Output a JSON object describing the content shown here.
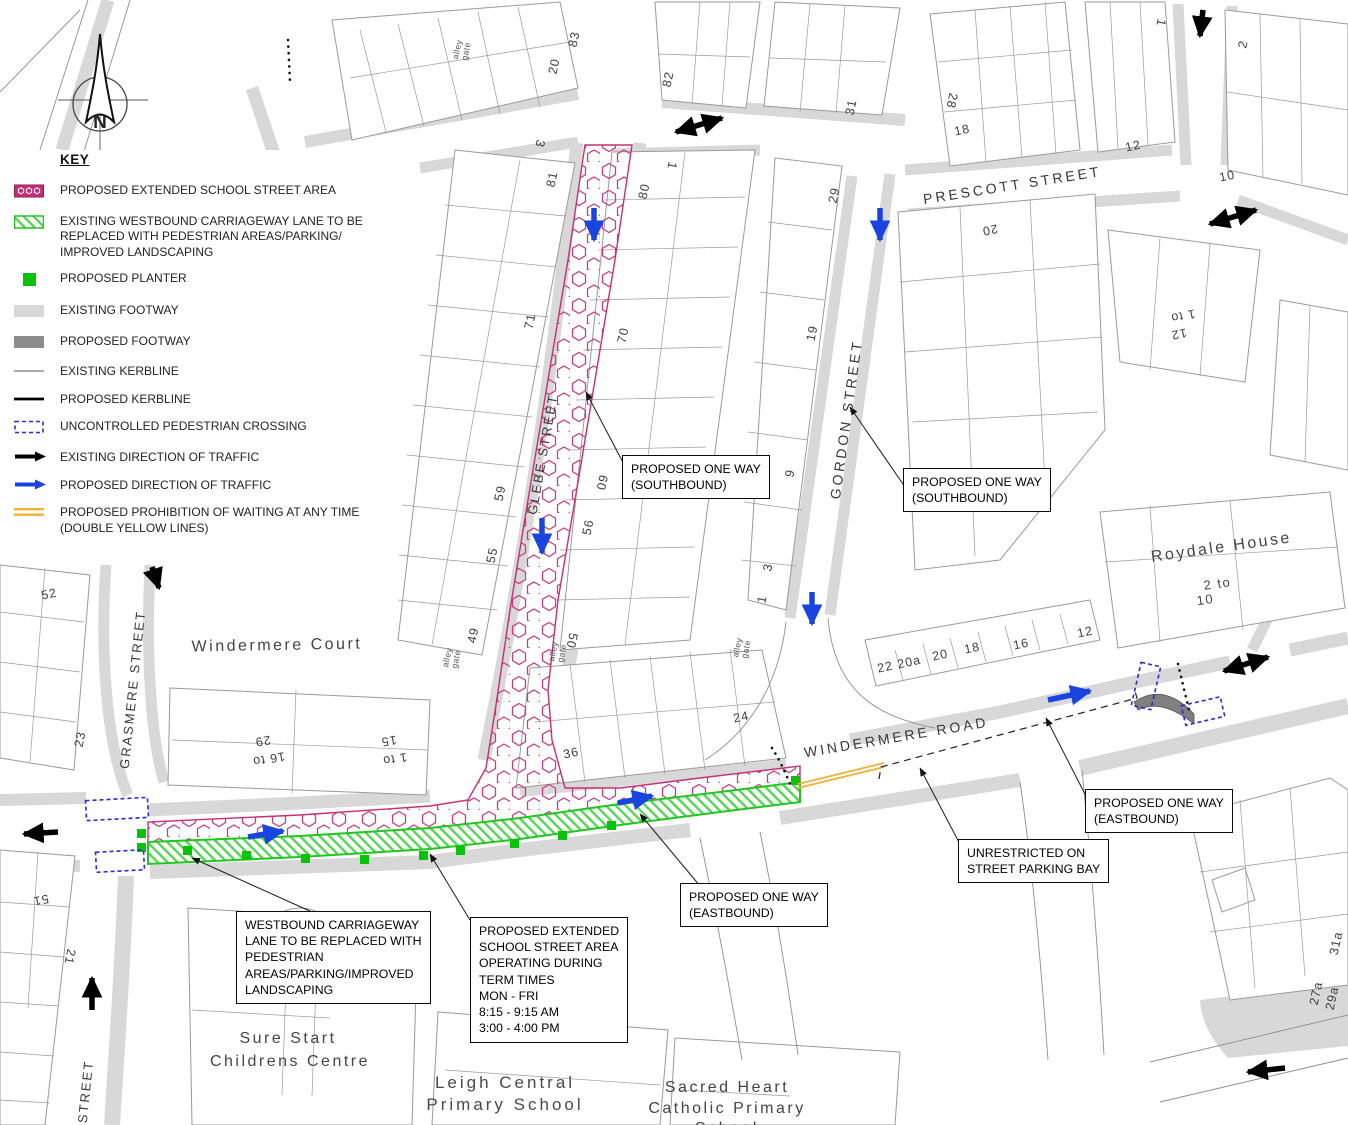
{
  "key": {
    "heading": "KEY",
    "items": [
      {
        "swatch": "school-street-hatch",
        "label": "PROPOSED EXTENDED SCHOOL STREET AREA"
      },
      {
        "swatch": "landscaping-hatch",
        "label": "EXISTING WESTBOUND CARRIAGEWAY LANE TO BE REPLACED WITH PEDESTRIAN AREAS/PARKING/ IMPROVED LANDSCAPING"
      },
      {
        "swatch": "planter-square",
        "label": "PROPOSED PLANTER"
      },
      {
        "swatch": "existing-footway",
        "label": "EXISTING FOOTWAY"
      },
      {
        "swatch": "proposed-footway",
        "label": "PROPOSED FOOTWAY"
      },
      {
        "swatch": "existing-kerbline",
        "label": "EXISTING KERBLINE"
      },
      {
        "swatch": "proposed-kerbline",
        "label": "PROPOSED KERBLINE"
      },
      {
        "swatch": "pedestrian-crossing",
        "label": "UNCONTROLLED PEDESTRIAN CROSSING"
      },
      {
        "swatch": "existing-traffic-arrow",
        "label": "EXISTING DIRECTION OF TRAFFIC"
      },
      {
        "swatch": "proposed-traffic-arrow",
        "label": "PROPOSED DIRECTION OF TRAFFIC"
      },
      {
        "swatch": "double-yellow-lines",
        "label": "PROPOSED PROHIBITION OF WAITING AT ANY TIME (DOUBLE YELLOW LINES)"
      }
    ]
  },
  "compass": {
    "label": "N"
  },
  "streets": {
    "prescott": "PRESCOTT STREET",
    "gordon": "GORDON STREET",
    "glebe": "GLEBE STREET",
    "windermere": "WINDERMERE ROAD",
    "grasmere": "GRASMERE STREET",
    "street_partial": "STREET"
  },
  "places": {
    "windermere_court": "Windermere Court",
    "roydale_house": "Roydale House",
    "roydale_range_1": "2 to",
    "roydale_range_2": "10",
    "sure_start_1": "Sure Start",
    "sure_start_2": "Childrens Centre",
    "leigh_1": "Leigh Central",
    "leigh_2": "Primary School",
    "sacred_1": "Sacred Heart",
    "sacred_2": "Catholic Primary",
    "sacred_3": "School"
  },
  "alley_gate": {
    "line1": "alley",
    "line2": "gate"
  },
  "house_numbers": [
    "83",
    "20",
    "82",
    "31",
    "28",
    "18",
    "12",
    "10",
    "1",
    "2",
    "3",
    "81",
    "1",
    "80",
    "29",
    "20",
    "71",
    "70",
    "60",
    "59",
    "56",
    "55",
    "50",
    "49",
    "19",
    "9",
    "3",
    "1",
    "36",
    "24",
    "22",
    "20a",
    "20",
    "18",
    "16",
    "12",
    "1 to",
    "12",
    "23",
    "52",
    "16 to",
    "29",
    "1 to",
    "15",
    "51",
    "21",
    "27a",
    "29a",
    "31a"
  ],
  "callouts": {
    "southbound_glebe": {
      "lines": [
        "PROPOSED ONE WAY",
        "(SOUTHBOUND)"
      ]
    },
    "southbound_gordon": {
      "lines": [
        "PROPOSED ONE WAY",
        "(SOUTHBOUND)"
      ]
    },
    "eastbound_west": {
      "lines": [
        "PROPOSED ONE WAY",
        "(EASTBOUND)"
      ]
    },
    "eastbound_east": {
      "lines": [
        "PROPOSED ONE WAY",
        "(EASTBOUND)"
      ]
    },
    "parking_bay": {
      "lines": [
        "UNRESTRICTED ON",
        "STREET PARKING BAY"
      ]
    },
    "westbound_lane": {
      "lines": [
        "WESTBOUND CARRIAGEWAY",
        "LANE TO BE REPLACED WITH",
        "PEDESTRIAN",
        "AREAS/PARKING/IMPROVED",
        "LANDSCAPING"
      ]
    },
    "school_street_times": {
      "lines": [
        "PROPOSED EXTENDED",
        "SCHOOL STREET AREA",
        "OPERATING DURING",
        "TERM TIMES",
        "MON - FRI",
        "8:15 - 9:15 AM",
        "3:00 - 4:00 PM"
      ]
    }
  },
  "colors": {
    "school_street_pink": "#c43076",
    "landscaping_green": "#22c522",
    "planter_green": "#0bc20b",
    "existing_footway_grey": "#d8d8d8",
    "proposed_footway_grey": "#8c8c8c",
    "crossing_blue": "#2a2ad8",
    "proposed_traffic_blue": "#1a44e0",
    "existing_traffic_black": "#000000",
    "double_yellow": "#f0b13a"
  }
}
